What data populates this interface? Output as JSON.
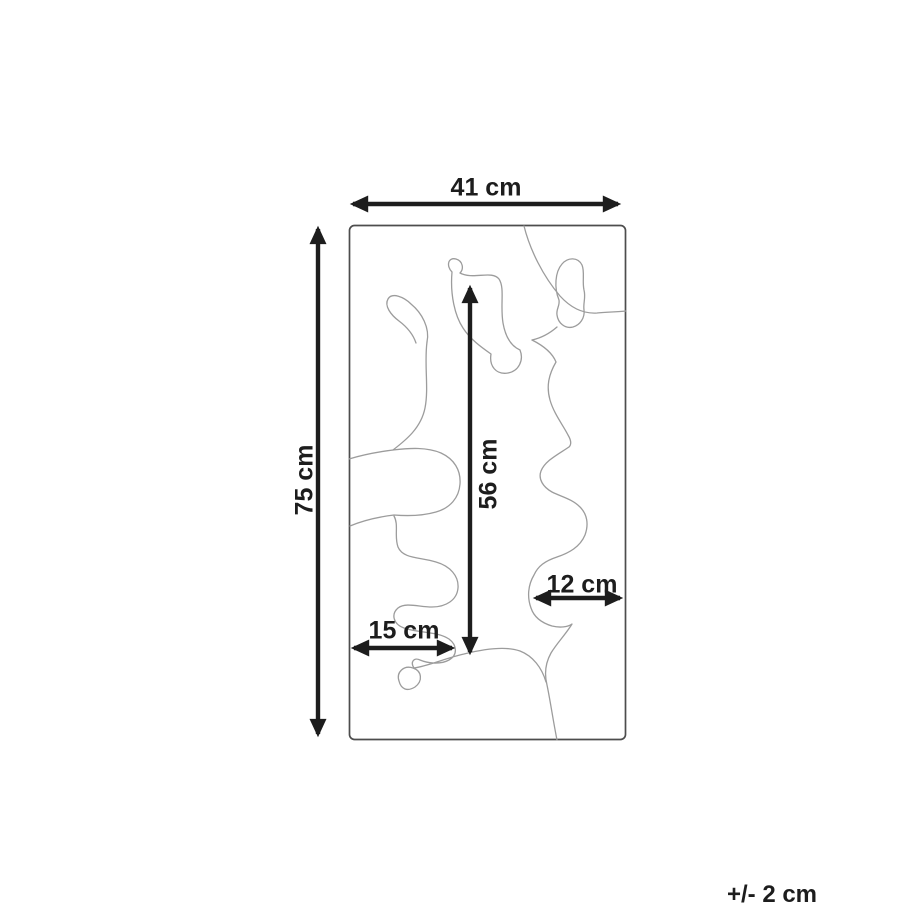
{
  "page": {
    "background_color": "#ffffff"
  },
  "diagram": {
    "kind": "product-dimension-drawing",
    "dimension_labels": {
      "overall_width": "41 cm",
      "overall_height": "75 cm",
      "inner_height": "56 cm",
      "lower_left_width": "15 cm",
      "right_gap_width": "12 cm"
    },
    "tolerance_note": "+/- 2 cm",
    "colors": {
      "dimension_arrows": "#1d1d1d",
      "label_text": "#1d1d1d",
      "rectangle_outline": "#4d4d4d",
      "shape_outline": "#9c9c9c",
      "background": "#ffffff"
    }
  }
}
